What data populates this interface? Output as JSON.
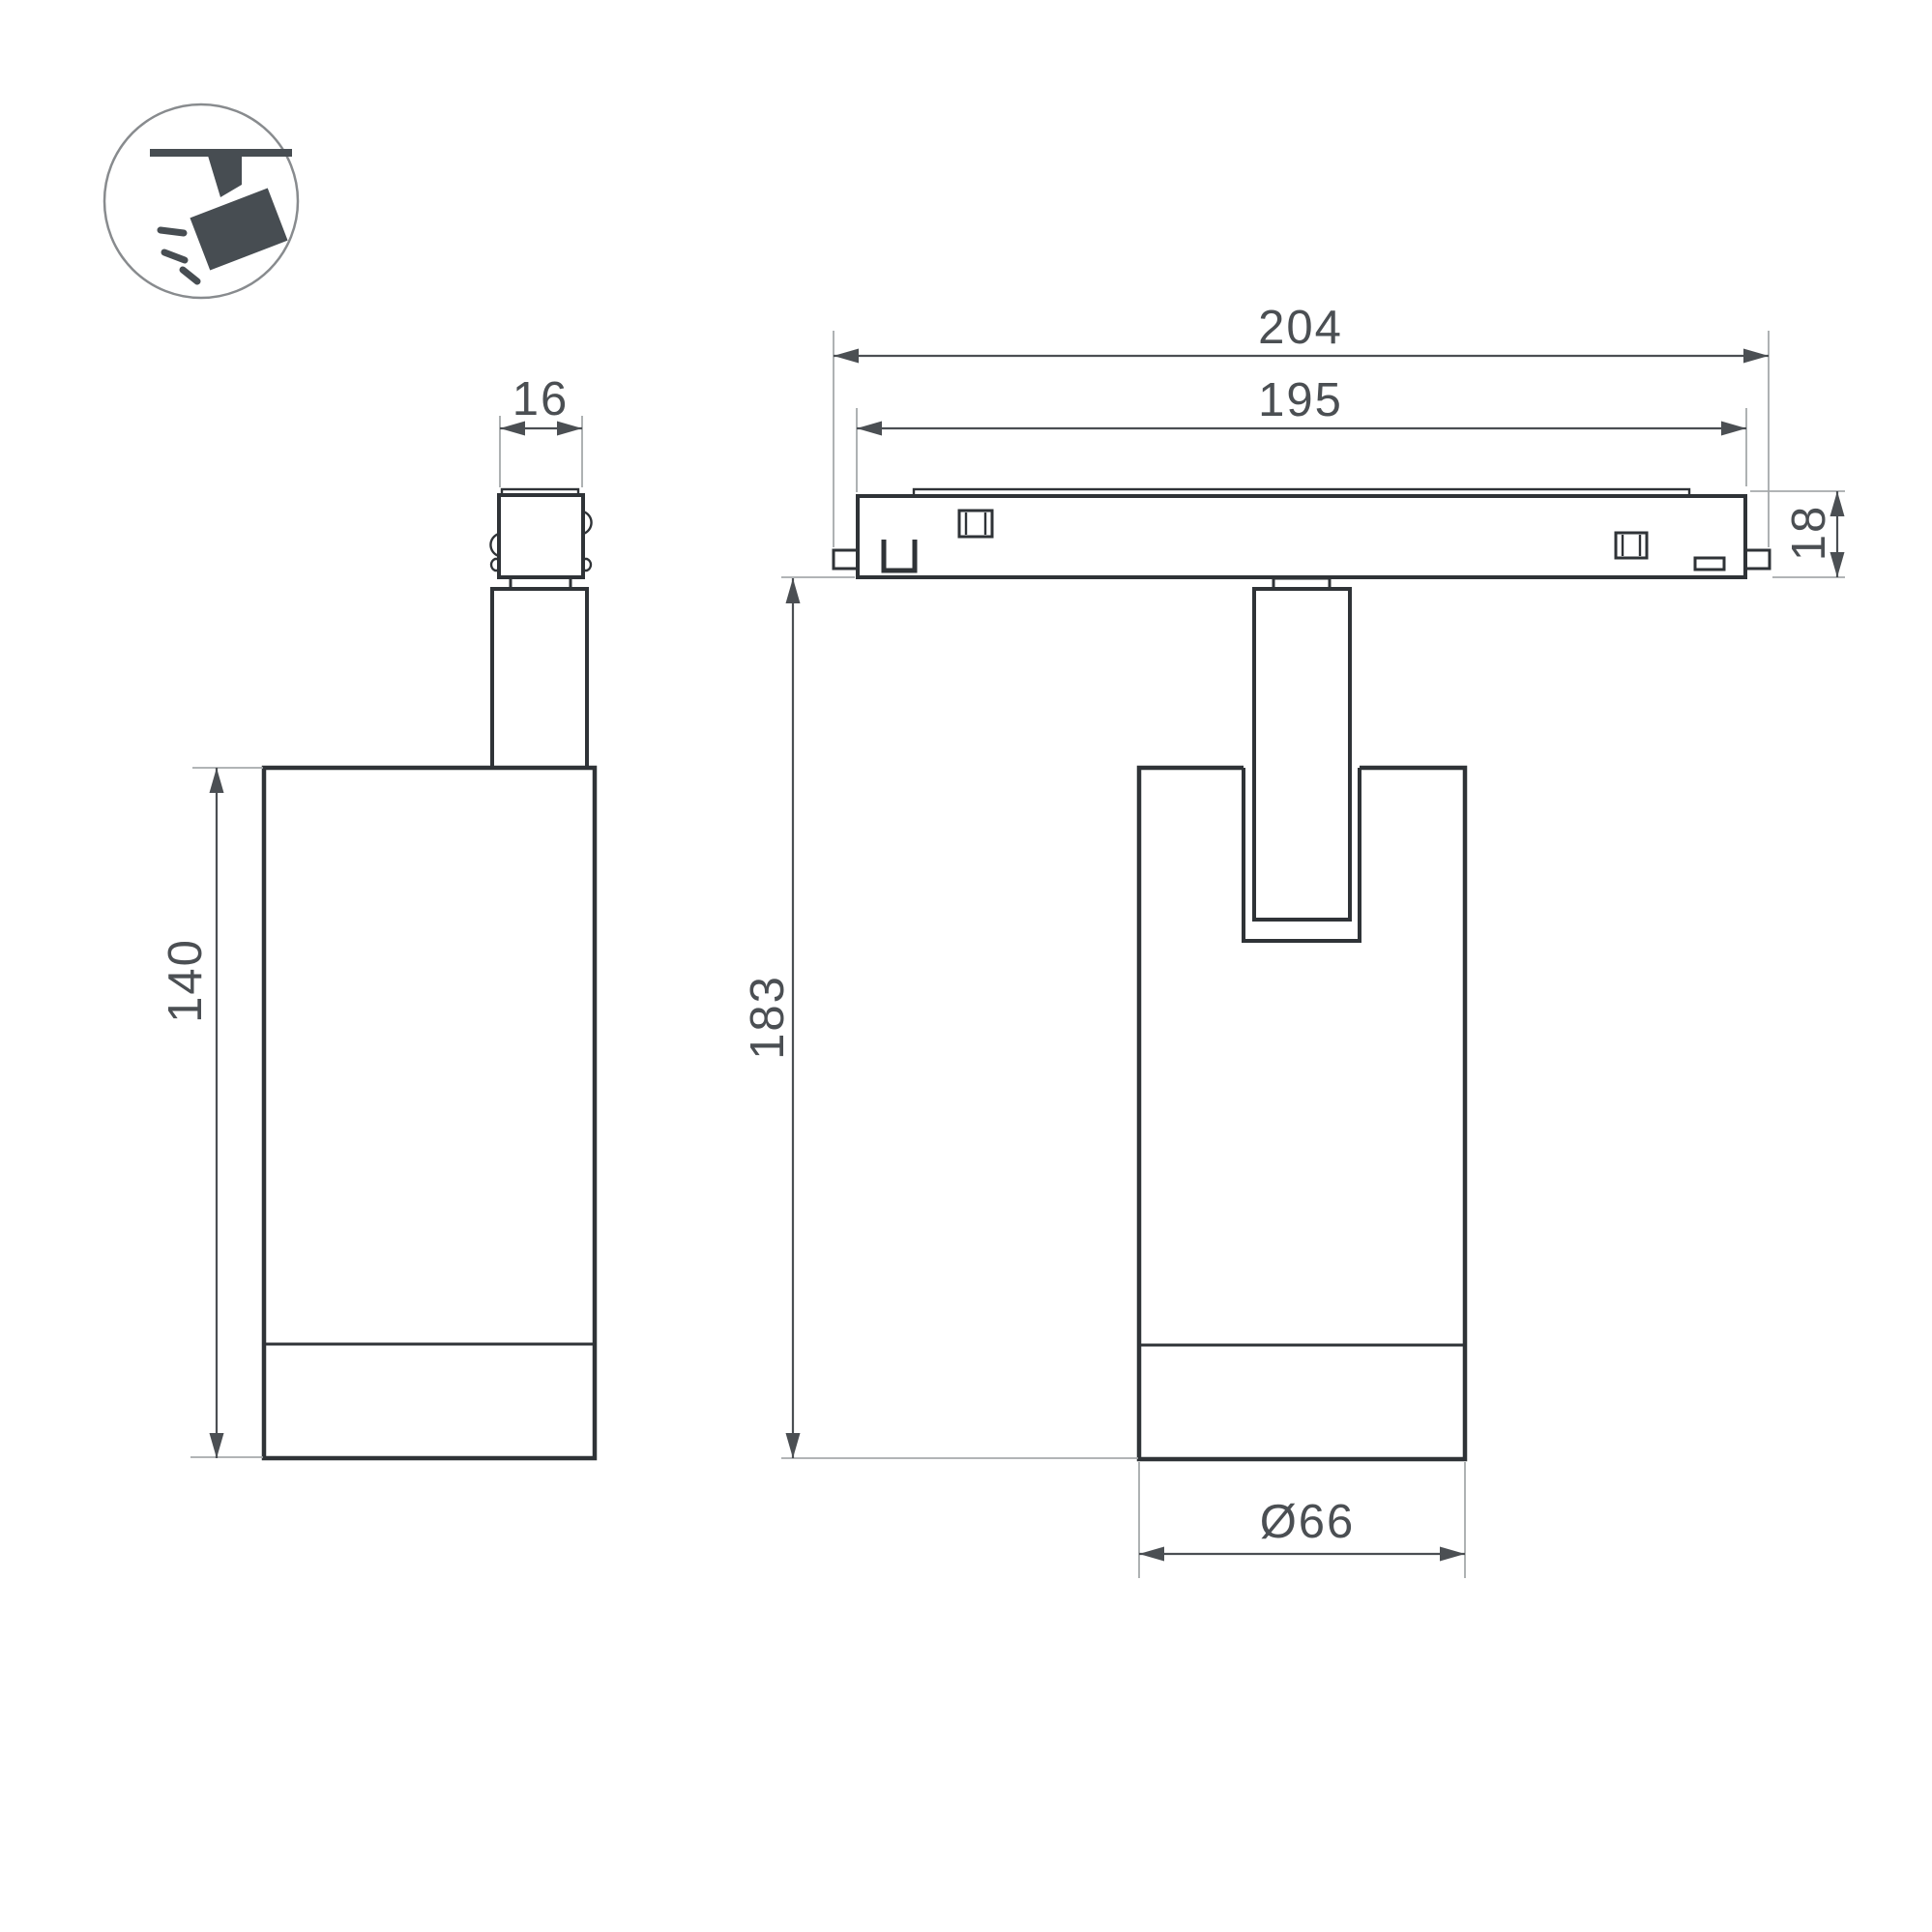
{
  "colors": {
    "background": "#ffffff",
    "object_line": "#2f3337",
    "dimension_line": "#4b4f53",
    "extension_line": "#a6a9ab",
    "label_text": "#4b4f53",
    "icon_fill": "#474d52",
    "icon_circle_stroke": "#888b8e"
  },
  "icon": {
    "name": "track-spotlight-icon"
  },
  "dimensions": {
    "adapter_width": "16",
    "track_length_overall": "204",
    "track_length_inner": "195",
    "track_height": "18",
    "body_height": "140",
    "overall_height": "183",
    "body_diameter": "Ø66"
  }
}
